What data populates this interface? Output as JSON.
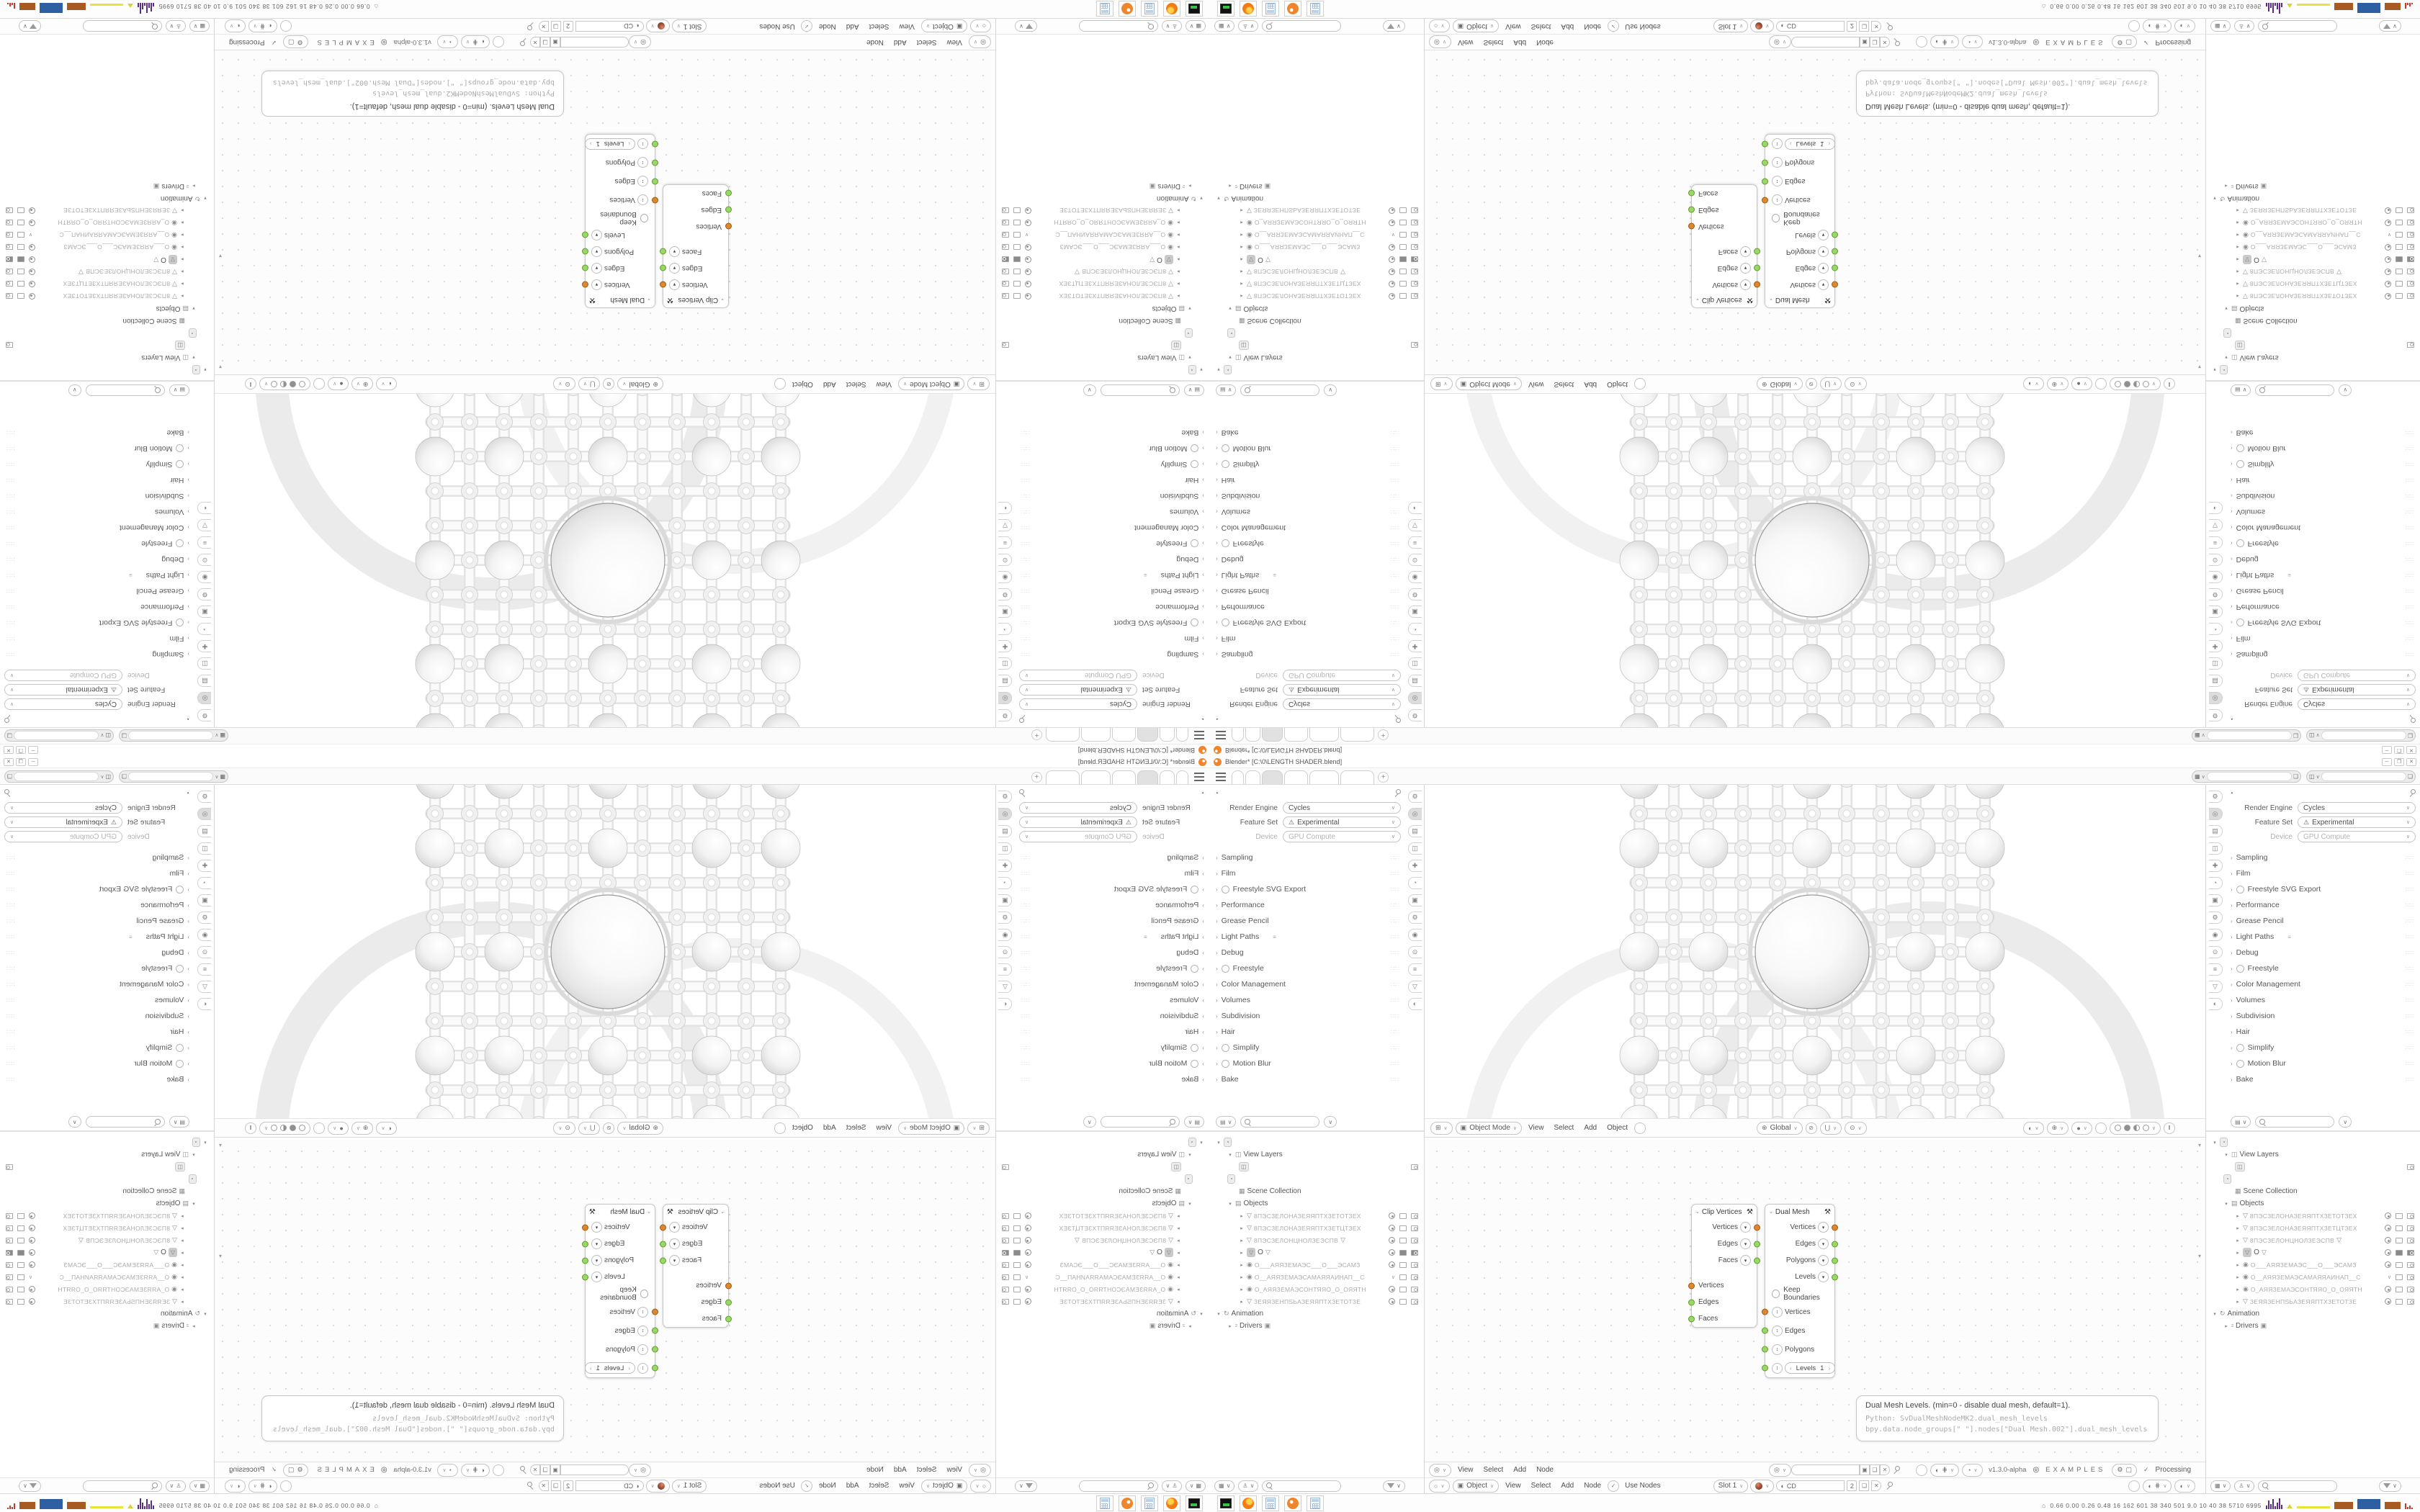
{
  "window": {
    "title": "Blender* [C:\\0\\LENGTH SHADER.blend]",
    "controls": [
      "─",
      "❐",
      "✕"
    ]
  },
  "topbar": {
    "tab_count": 6,
    "active_tab": 2,
    "new_tab_label": "+"
  },
  "properties": {
    "fields": [
      {
        "label": "Render Engine",
        "value": "Cycles",
        "warn": false,
        "muted": false
      },
      {
        "label": "Feature Set",
        "value": "Experimental",
        "warn": true,
        "muted": false
      },
      {
        "label": "Device",
        "value": "GPU Compute",
        "warn": false,
        "muted": true
      }
    ],
    "panels": [
      {
        "label": "Sampling",
        "toggle": false
      },
      {
        "label": "Film",
        "toggle": false
      },
      {
        "label": "Freestyle SVG Export",
        "toggle": true
      },
      {
        "label": "Performance",
        "toggle": false
      },
      {
        "label": "Grease Pencil",
        "toggle": false
      },
      {
        "label": "Light Paths",
        "toggle": false,
        "extra": true
      },
      {
        "label": "Debug",
        "toggle": false
      },
      {
        "label": "Freestyle",
        "toggle": true
      },
      {
        "label": "Color Management",
        "toggle": false
      },
      {
        "label": "Volumes",
        "toggle": false
      },
      {
        "label": "Subdivision",
        "toggle": false
      },
      {
        "label": "Hair",
        "toggle": false
      },
      {
        "label": "Simplify",
        "toggle": true
      },
      {
        "label": "Motion Blur",
        "toggle": true
      },
      {
        "label": "Bake",
        "toggle": false
      }
    ],
    "tabs": [
      {
        "glyph": "⚙",
        "name": "tool",
        "active": false
      },
      {
        "glyph": "◎",
        "name": "render",
        "active": true
      },
      {
        "glyph": "▤",
        "name": "output",
        "active": false
      },
      {
        "glyph": "◫",
        "name": "view-layer",
        "active": false
      },
      {
        "glyph": "✚",
        "name": "scene",
        "active": false
      },
      {
        "glyph": "◔",
        "name": "world",
        "active": false
      },
      {
        "glyph": "▣",
        "name": "object",
        "active": false
      },
      {
        "glyph": "⚙",
        "name": "modifiers",
        "active": false
      },
      {
        "glyph": "◉",
        "name": "particles",
        "active": false
      },
      {
        "glyph": "⊙",
        "name": "physics",
        "active": false
      },
      {
        "glyph": "≡",
        "name": "constraints",
        "active": false
      },
      {
        "glyph": "▽",
        "name": "object-data",
        "active": false
      },
      {
        "glyph": "◐",
        "name": "material",
        "active": false
      }
    ]
  },
  "outliner": {
    "items": [
      {
        "depth": 0,
        "caret": "▾",
        "chip": "◔",
        "label": "",
        "rights": []
      },
      {
        "depth": 1,
        "caret": "▾",
        "icon": "◫",
        "label": "View Layers",
        "rights": []
      },
      {
        "depth": 2,
        "chip": "◫",
        "label": "",
        "rights": [
          "cam"
        ]
      },
      {
        "depth": 1,
        "chip": "◔",
        "label": "",
        "rights": []
      },
      {
        "depth": 2,
        "icon": "▦",
        "label": "Scene Collection",
        "rights": []
      },
      {
        "depth": 1,
        "caret": "▾",
        "icon": "▤",
        "label": "Objects",
        "rights": []
      },
      {
        "depth": 2,
        "caret": "▸",
        "icon": "▽",
        "label": "8ПЭСЗЕЛОНАЗЕЯЯПТХЗЕТОТЗЕХ",
        "hash": true,
        "rights": [
          "eye",
          "mon",
          "cam"
        ]
      },
      {
        "depth": 2,
        "caret": "▸",
        "icon": "▽",
        "label": "8ПЭСЗЕЛОНАЗЕЯЯПТХЗЕТЦТЗЕХ",
        "hash": true,
        "rights": [
          "eye",
          "mon",
          "cam"
        ]
      },
      {
        "depth": 2,
        "caret": "▸",
        "icon": "▽",
        "label": "8ПЭСЗЕЛОНЦНОЛЗЕЭСПВ",
        "hash": true,
        "mid": "▽",
        "rights": [
          "eye",
          "mon",
          "cam"
        ]
      },
      {
        "depth": 2,
        "caret": "▸",
        "chip": "▽",
        "chipsel": true,
        "label": "O",
        "mid": "▽",
        "rights": [
          "eye",
          "monf",
          "camf"
        ]
      },
      {
        "depth": 2,
        "caret": "▸",
        "icon": "◉",
        "label": "O___АЯЯЗЕМАЭС___О___ЭСАМЗ",
        "hash": true,
        "rights": [
          "eye",
          "mon",
          "cam"
        ]
      },
      {
        "depth": 2,
        "caret": "▸",
        "icon": "◉",
        "label": "O__АЯЯЗЕМАЭСАМАЯЯАИНАП__С",
        "hash": true,
        "rights": [
          "chev",
          "mon",
          "cam"
        ]
      },
      {
        "depth": 2,
        "caret": "▸",
        "icon": "◉",
        "label": "O_АЯЯЗЕМАЭСОНТЯЯО_О_ОЯЯТН",
        "hash": true,
        "rights": [
          "eye",
          "mon",
          "cam"
        ]
      },
      {
        "depth": 2,
        "caret": "▸",
        "icon": "▽",
        "label": "ЗЕЯЯЗЕНПЅЬАЗЕЯЯПТХЗЕТОТЗЕ",
        "hash": true,
        "rights": [
          "eye",
          "mon",
          "cam"
        ]
      },
      {
        "depth": 0,
        "caret": "▾",
        "icon": "↻",
        "label": "Animation",
        "rights": []
      },
      {
        "depth": 1,
        "caret": "▸",
        "icon": "²",
        "label": "Drivers",
        "trail": "▣",
        "rights": []
      }
    ]
  },
  "viewport_header": {
    "editor_icon": "⊞",
    "mode": "Object Mode",
    "menus": [
      "View",
      "Select",
      "Add",
      "Object"
    ],
    "transform_orientation": "Global"
  },
  "sverchok_header": {
    "menus": [
      "View",
      "Select",
      "Add",
      "Node"
    ],
    "version": "v1.3.0-alpha",
    "examples": "EXAMPLES",
    "status": "Processing"
  },
  "shader_header": {
    "type_label": "Object",
    "menus": [
      "View",
      "Select",
      "Add",
      "Node"
    ],
    "use_nodes": "Use Nodes",
    "slot": "Slot 1",
    "material_name": "CD",
    "user_count": "2"
  },
  "node_editor": {
    "nodes": [
      {
        "title": "Clip Vertices",
        "outputs": [
          {
            "name": "Vertices",
            "color": "orange"
          },
          {
            "name": "Edges",
            "color": "green"
          },
          {
            "name": "Faces",
            "color": "green"
          }
        ],
        "inputs": [
          {
            "name": "Vertices",
            "color": "orange"
          },
          {
            "name": "Edges",
            "color": "green"
          },
          {
            "name": "Faces",
            "color": "green"
          }
        ]
      },
      {
        "title": "Dual Mesh",
        "outputs": [
          {
            "name": "Vertices",
            "color": "orange"
          },
          {
            "name": "Edges",
            "color": "green"
          },
          {
            "name": "Polygons",
            "color": "green"
          },
          {
            "name": "Levels",
            "color": "green"
          }
        ],
        "checkbox": "Keep Boundaries",
        "inputs": [
          {
            "name": "Vertices",
            "color": "orange"
          },
          {
            "name": "Edges",
            "color": "green"
          },
          {
            "name": "Polygons",
            "color": "green"
          },
          {
            "name": "Levels",
            "color": "green",
            "value": "1"
          }
        ]
      }
    ],
    "tooltip": {
      "line1": "Dual Mesh Levels. (min=0 - disable dual mesh, default=1).",
      "line2": "Python: SvDualMeshNodeMK2.dual_mesh_levels",
      "line3": "bpy.data.node_groups[\" \"].nodes[\"Dual Mesh.002\"].dual_mesh_levels"
    }
  },
  "taskbar": {
    "stats": "0.66 0.00 0.26 0.48   16   162   601   38   340   501   9.0   10   40   38   5710 6995"
  },
  "colors": {
    "socket_orange": "#e0862c",
    "socket_green": "#96d964",
    "active_chip": "#c9c9c9"
  }
}
